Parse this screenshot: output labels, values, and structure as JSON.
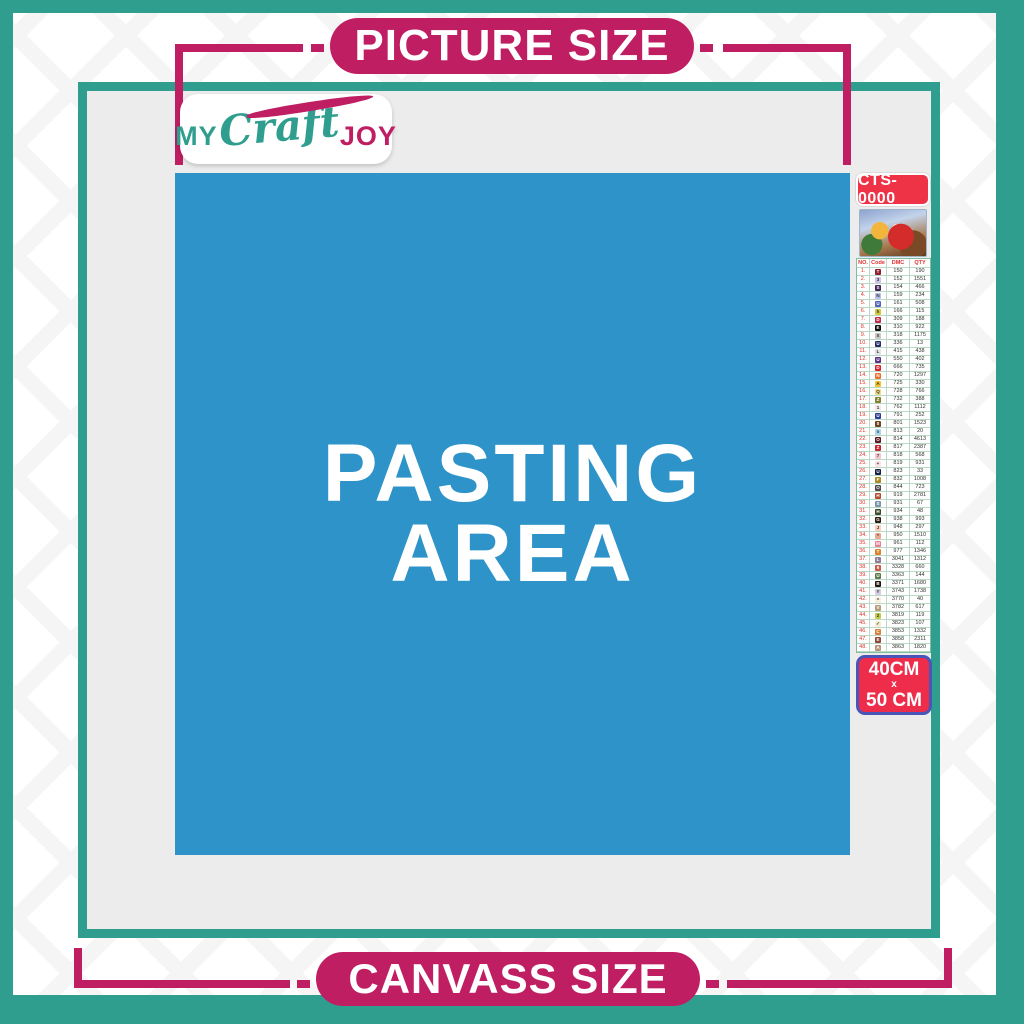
{
  "banners": {
    "picture_size": "PICTURE SIZE",
    "canvass_size": "CANVASS SIZE"
  },
  "logo": {
    "word1": "MY",
    "word2": "Craft",
    "word3": "JOY"
  },
  "pasting_area": {
    "line1": "PASTING",
    "line2": "AREA"
  },
  "product": {
    "code": "CTS-0000",
    "size": {
      "line1": "40CM",
      "line2": "x",
      "line3": "50 CM"
    }
  },
  "colors": {
    "teal": "#2f9e8e",
    "magenta": "#c01e63",
    "blue": "#2d93c8",
    "canvas_gray": "#ececec",
    "badge_red": "#ee3347",
    "badge_border_indigo": "#4a55b8"
  },
  "color_chart": {
    "headers": [
      "NO.",
      "Code",
      "DMC",
      "QTY"
    ],
    "rows": [
      {
        "no": "1.",
        "symbol": "T",
        "bg": "#8e1f2c",
        "fg": "#ffffff",
        "dmc": "150",
        "qty": "190"
      },
      {
        "no": "2.",
        "symbol": "3",
        "bg": "#cdc1e6",
        "fg": "#333333",
        "dmc": "152",
        "qty": "1551"
      },
      {
        "no": "3.",
        "symbol": "S",
        "bg": "#46265a",
        "fg": "#ffffff",
        "dmc": "154",
        "qty": "466"
      },
      {
        "no": "4.",
        "symbol": "N",
        "bg": "#b8bfe8",
        "fg": "#333333",
        "dmc": "159",
        "qty": "234"
      },
      {
        "no": "5.",
        "symbol": "U",
        "bg": "#4f64b8",
        "fg": "#ffffff",
        "dmc": "161",
        "qty": "508"
      },
      {
        "no": "6.",
        "symbol": "h",
        "bg": "#cfcb3a",
        "fg": "#333333",
        "dmc": "166",
        "qty": "115"
      },
      {
        "no": "7.",
        "symbol": "D",
        "bg": "#c22b47",
        "fg": "#ffffff",
        "dmc": "309",
        "qty": "188"
      },
      {
        "no": "8.",
        "symbol": "E",
        "bg": "#101010",
        "fg": "#ffffff",
        "dmc": "310",
        "qty": "922"
      },
      {
        "no": "9.",
        "symbol": "X",
        "bg": "#c9c9c9",
        "fg": "#333333",
        "dmc": "318",
        "qty": "1175"
      },
      {
        "no": "10.",
        "symbol": "U",
        "bg": "#232d66",
        "fg": "#ffffff",
        "dmc": "336",
        "qty": "13"
      },
      {
        "no": "11.",
        "symbol": "L",
        "bg": "#e3e3e6",
        "fg": "#333333",
        "dmc": "415",
        "qty": "438"
      },
      {
        "no": "12.",
        "symbol": "U",
        "bg": "#5b2f88",
        "fg": "#ffffff",
        "dmc": "550",
        "qty": "402"
      },
      {
        "no": "13.",
        "symbol": "D",
        "bg": "#d8232f",
        "fg": "#ffffff",
        "dmc": "666",
        "qty": "735"
      },
      {
        "no": "14.",
        "symbol": "N",
        "bg": "#ea6f2d",
        "fg": "#ffffff",
        "dmc": "720",
        "qty": "1297"
      },
      {
        "no": "15.",
        "symbol": "A",
        "bg": "#f2c12e",
        "fg": "#333333",
        "dmc": "725",
        "qty": "330"
      },
      {
        "no": "16.",
        "symbol": "Q",
        "bg": "#f3dc82",
        "fg": "#333333",
        "dmc": "728",
        "qty": "766"
      },
      {
        "no": "17.",
        "symbol": "Z",
        "bg": "#83802c",
        "fg": "#ffffff",
        "dmc": "732",
        "qty": "388"
      },
      {
        "no": "18.",
        "symbol": "1",
        "bg": "#f6e9e9",
        "fg": "#333333",
        "dmc": "762",
        "qty": "1112"
      },
      {
        "no": "19.",
        "symbol": "U",
        "bg": "#2c3e91",
        "fg": "#ffffff",
        "dmc": "791",
        "qty": "252"
      },
      {
        "no": "20.",
        "symbol": "0",
        "bg": "#6e4423",
        "fg": "#ffffff",
        "dmc": "801",
        "qty": "1523"
      },
      {
        "no": "21.",
        "symbol": "o",
        "bg": "#aed6ea",
        "fg": "#1d4f6e",
        "dmc": "813",
        "qty": "20"
      },
      {
        "no": "22.",
        "symbol": "O",
        "bg": "#5c1a24",
        "fg": "#ffffff",
        "dmc": "814",
        "qty": "4613"
      },
      {
        "no": "23.",
        "symbol": "Z",
        "bg": "#c6252f",
        "fg": "#ffffff",
        "dmc": "817",
        "qty": "2387"
      },
      {
        "no": "24.",
        "symbol": "7",
        "bg": "#f3c6ce",
        "fg": "#333333",
        "dmc": "818",
        "qty": "568"
      },
      {
        "no": "25.",
        "symbol": "+",
        "bg": "#f9e3e6",
        "fg": "#333333",
        "dmc": "819",
        "qty": "931"
      },
      {
        "no": "26.",
        "symbol": "U",
        "bg": "#161e42",
        "fg": "#ffffff",
        "dmc": "823",
        "qty": "33"
      },
      {
        "no": "27.",
        "symbol": "F",
        "bg": "#ab8a26",
        "fg": "#ffffff",
        "dmc": "832",
        "qty": "1008"
      },
      {
        "no": "28.",
        "symbol": "O",
        "bg": "#4b4b4b",
        "fg": "#ffffff",
        "dmc": "844",
        "qty": "723"
      },
      {
        "no": "29.",
        "symbol": "H",
        "bg": "#b44a2b",
        "fg": "#ffffff",
        "dmc": "919",
        "qty": "2781"
      },
      {
        "no": "30.",
        "symbol": "S",
        "bg": "#7d95aa",
        "fg": "#ffffff",
        "dmc": "931",
        "qty": "67"
      },
      {
        "no": "31.",
        "symbol": "H",
        "bg": "#3c4a2c",
        "fg": "#ffffff",
        "dmc": "934",
        "qty": "48"
      },
      {
        "no": "32.",
        "symbol": "G",
        "bg": "#2c1d12",
        "fg": "#ffffff",
        "dmc": "938",
        "qty": "993"
      },
      {
        "no": "33.",
        "symbol": "J",
        "bg": "#f6d0b8",
        "fg": "#333333",
        "dmc": "948",
        "qty": "297"
      },
      {
        "no": "34.",
        "symbol": "*",
        "bg": "#eaa890",
        "fg": "#333333",
        "dmc": "950",
        "qty": "1510"
      },
      {
        "no": "35.",
        "symbol": "M",
        "bg": "#e97f92",
        "fg": "#ffffff",
        "dmc": "961",
        "qty": "112"
      },
      {
        "no": "36.",
        "symbol": "T",
        "bg": "#da832c",
        "fg": "#ffffff",
        "dmc": "977",
        "qty": "1346"
      },
      {
        "no": "37.",
        "symbol": "L",
        "bg": "#8d7e97",
        "fg": "#ffffff",
        "dmc": "3041",
        "qty": "1312"
      },
      {
        "no": "38.",
        "symbol": "9",
        "bg": "#c75c49",
        "fg": "#ffffff",
        "dmc": "3328",
        "qty": "660"
      },
      {
        "no": "39.",
        "symbol": "U",
        "bg": "#5d7a49",
        "fg": "#ffffff",
        "dmc": "3363",
        "qty": "144"
      },
      {
        "no": "40.",
        "symbol": "B",
        "bg": "#201610",
        "fg": "#ffffff",
        "dmc": "3371",
        "qty": "1680"
      },
      {
        "no": "41.",
        "symbol": "Y",
        "bg": "#d5cfe4",
        "fg": "#333333",
        "dmc": "3743",
        "qty": "1738"
      },
      {
        "no": "42.",
        "symbol": "^",
        "bg": "#f9efdd",
        "fg": "#333333",
        "dmc": "3770",
        "qty": "40"
      },
      {
        "no": "43.",
        "symbol": "V",
        "bg": "#b69b7d",
        "fg": "#ffffff",
        "dmc": "3782",
        "qty": "617"
      },
      {
        "no": "44.",
        "symbol": "2",
        "bg": "#c3cc49",
        "fg": "#333333",
        "dmc": "3819",
        "qty": "119"
      },
      {
        "no": "45.",
        "symbol": "✓",
        "bg": "#f5ecd2",
        "fg": "#333333",
        "dmc": "3823",
        "qty": "107"
      },
      {
        "no": "46.",
        "symbol": "C",
        "bg": "#d8813f",
        "fg": "#ffffff",
        "dmc": "3853",
        "qty": "1332"
      },
      {
        "no": "47.",
        "symbol": "E",
        "bg": "#8d4a3c",
        "fg": "#ffffff",
        "dmc": "3858",
        "qty": "2311"
      },
      {
        "no": "48.",
        "symbol": "A",
        "bg": "#b59478",
        "fg": "#ffffff",
        "dmc": "3863",
        "qty": "1820"
      }
    ]
  }
}
